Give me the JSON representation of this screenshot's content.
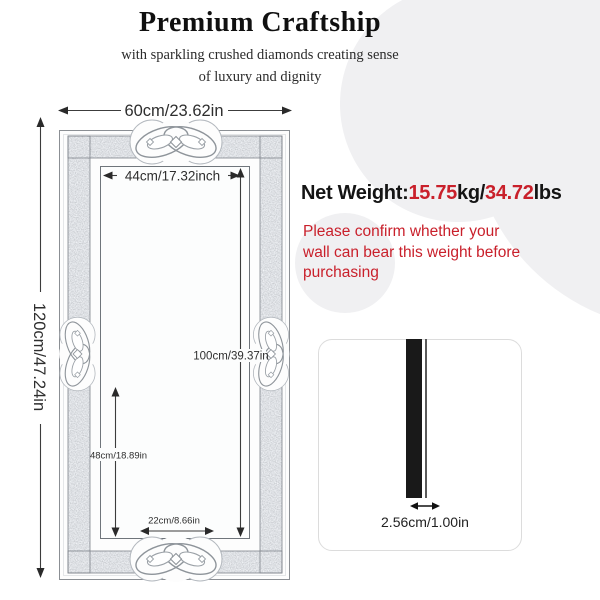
{
  "header": {
    "title": "Premium Craftship",
    "subtitle_line1": "with sparkling crushed diamonds creating sense",
    "subtitle_line2": "of luxury and dignity"
  },
  "mirror_diagram": {
    "outer_width_label": "60cm/23.62in",
    "outer_height_label": "120cm/47.24in",
    "inner_width_label": "44cm/17.32inch",
    "inner_height_label": "100cm/39.37in",
    "lower_section_label": "48cm/18.89in",
    "bottom_width_label": "22cm/8.66in"
  },
  "net_weight": {
    "label": "Net Weight:",
    "kg_value": "15.75",
    "kg_unit": "kg/",
    "lbs_value": "34.72",
    "lbs_unit": "lbs"
  },
  "warning": {
    "line1": "Please confirm whether your",
    "line2": "wall can bear this weight before",
    "line3": "purchasing"
  },
  "thickness": {
    "label": "2.56cm/1.00in"
  },
  "colors": {
    "accent_red": "#c9202b",
    "text_dark": "#141414",
    "sparkle_band": "#b7bdc5",
    "frame_outline": "#8b8f94",
    "background_circle": "#f0f0f2"
  }
}
